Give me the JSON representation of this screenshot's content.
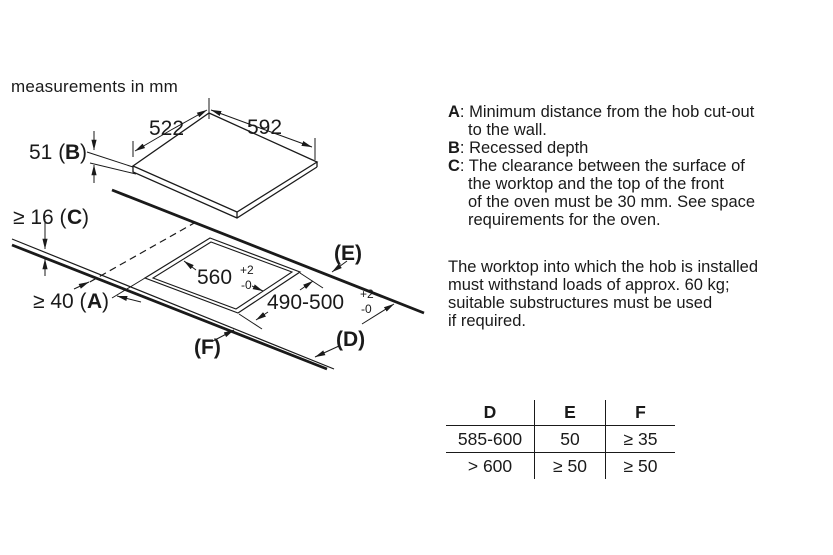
{
  "diagram": {
    "note": "measurements in mm",
    "labels": {
      "width_left_edge": "522",
      "width_right_edge": "592",
      "recess_prefix": "51 (",
      "recess_letter": "B",
      "recess_suffix": ")",
      "thickness_prefix": "≥ 16 (",
      "thickness_letter": "C",
      "thickness_suffix": ")",
      "wall_prefix": "≥ 40 (",
      "wall_letter": "A",
      "wall_suffix": ")",
      "cutout_width": "560",
      "cutout_width_tol_plus": "+2",
      "cutout_width_tol_minus": "-0",
      "cutout_depth": "490-500",
      "cutout_depth_tol_plus": "+2",
      "cutout_depth_tol_minus": "-0",
      "edge_e": "(E)",
      "edge_d": "(D)",
      "edge_f": "(F)"
    }
  },
  "legend": {
    "separator": ":",
    "items": [
      {
        "letter": "A",
        "lines": [
          "Minimum distance from the hob cut-out",
          "to the wall."
        ]
      },
      {
        "letter": "B",
        "lines": [
          "Recessed depth"
        ]
      },
      {
        "letter": "C",
        "lines": [
          "The clearance between the surface of",
          "the worktop and the top of the front",
          "of the oven must be 30 mm. See space",
          "requirements for the oven."
        ]
      }
    ]
  },
  "paragraph": {
    "lines": [
      "The worktop into which the hob is installed",
      "must withstand loads of approx. 60 kg;",
      "suitable substructures must be used",
      "if required."
    ]
  },
  "table": {
    "headers": [
      "D",
      "E",
      "F"
    ],
    "rows": [
      [
        "585-600",
        "50",
        "≥ 35"
      ],
      [
        "> 600",
        "≥ 50",
        "≥ 50"
      ]
    ]
  },
  "colors": {
    "ink": "#1a1a1a",
    "background": "#ffffff"
  }
}
